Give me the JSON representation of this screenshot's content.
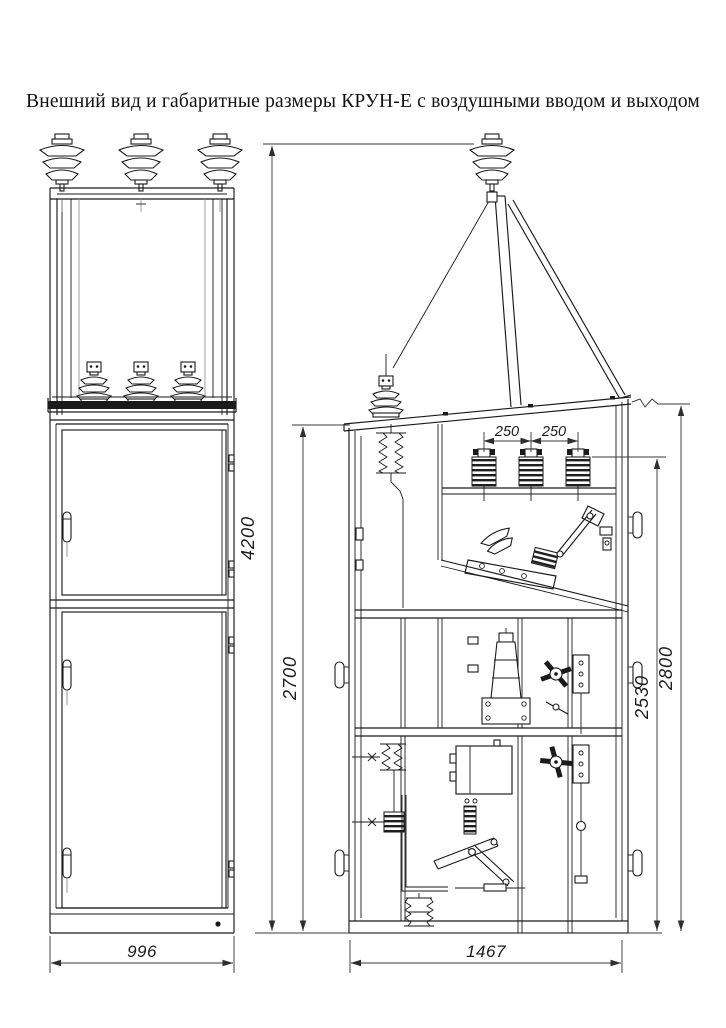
{
  "title": "Внешний вид и габаритные размеры КРУН-Е с воздушными вводом и выходом",
  "dimensions": {
    "overall_height": "4200",
    "cabinet_height": "2700",
    "bushing_height": "2530",
    "roof_height": "2800",
    "phase_spacing_left": "250",
    "phase_spacing_right": "250",
    "front_width": "996",
    "depth": "1467"
  },
  "colors": {
    "background": "#ffffff",
    "line": "#1a1a1a",
    "dimension": "#3a3a3a"
  }
}
